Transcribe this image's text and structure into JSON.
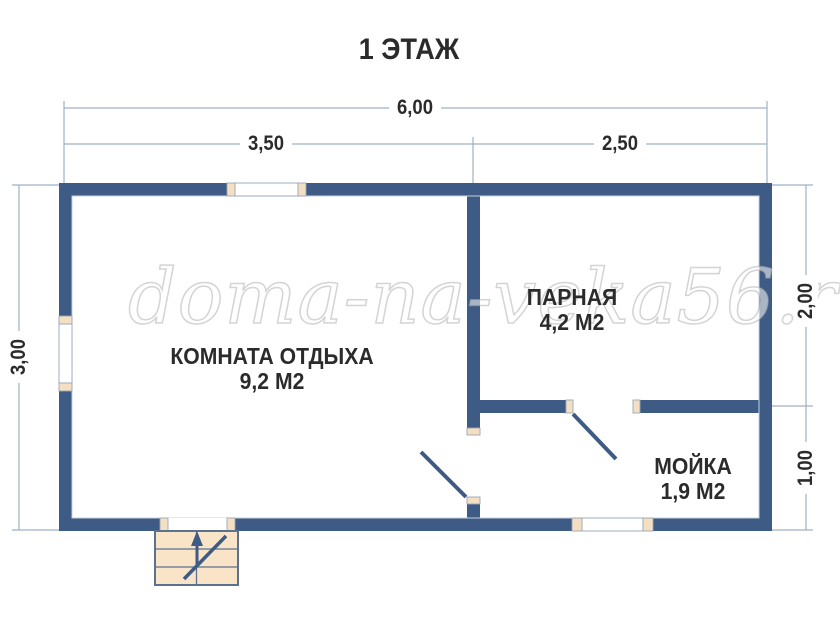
{
  "title": "1 ЭТАЖ",
  "watermark": "doma-na-veka56.ru",
  "dimensions": {
    "width_total": "6,00",
    "width_left": "3,50",
    "width_right": "2,50",
    "height_left": "3,00",
    "height_right_top": "2,00",
    "height_right_bottom": "1,00"
  },
  "rooms": [
    {
      "name": "КОМНАТА ОТДЫХА",
      "area": "9,2 М2"
    },
    {
      "name": "ПАРНАЯ",
      "area": "4,2 М2"
    },
    {
      "name": "МОЙКА",
      "area": "1,9 М2"
    }
  ],
  "colors": {
    "wall": "#3d5b84",
    "opening-frame": "#f5dfc2",
    "opening-frame-stroke": "#9aa7b5",
    "opening-glass-stroke": "#94a7bc",
    "dim-line": "#9db0c2",
    "label-text": "#2b2b2b",
    "inner-edge": "#c5d0dc",
    "stairs-fill": "#f9e4c8",
    "stairs-stroke": "#5a7190"
  }
}
